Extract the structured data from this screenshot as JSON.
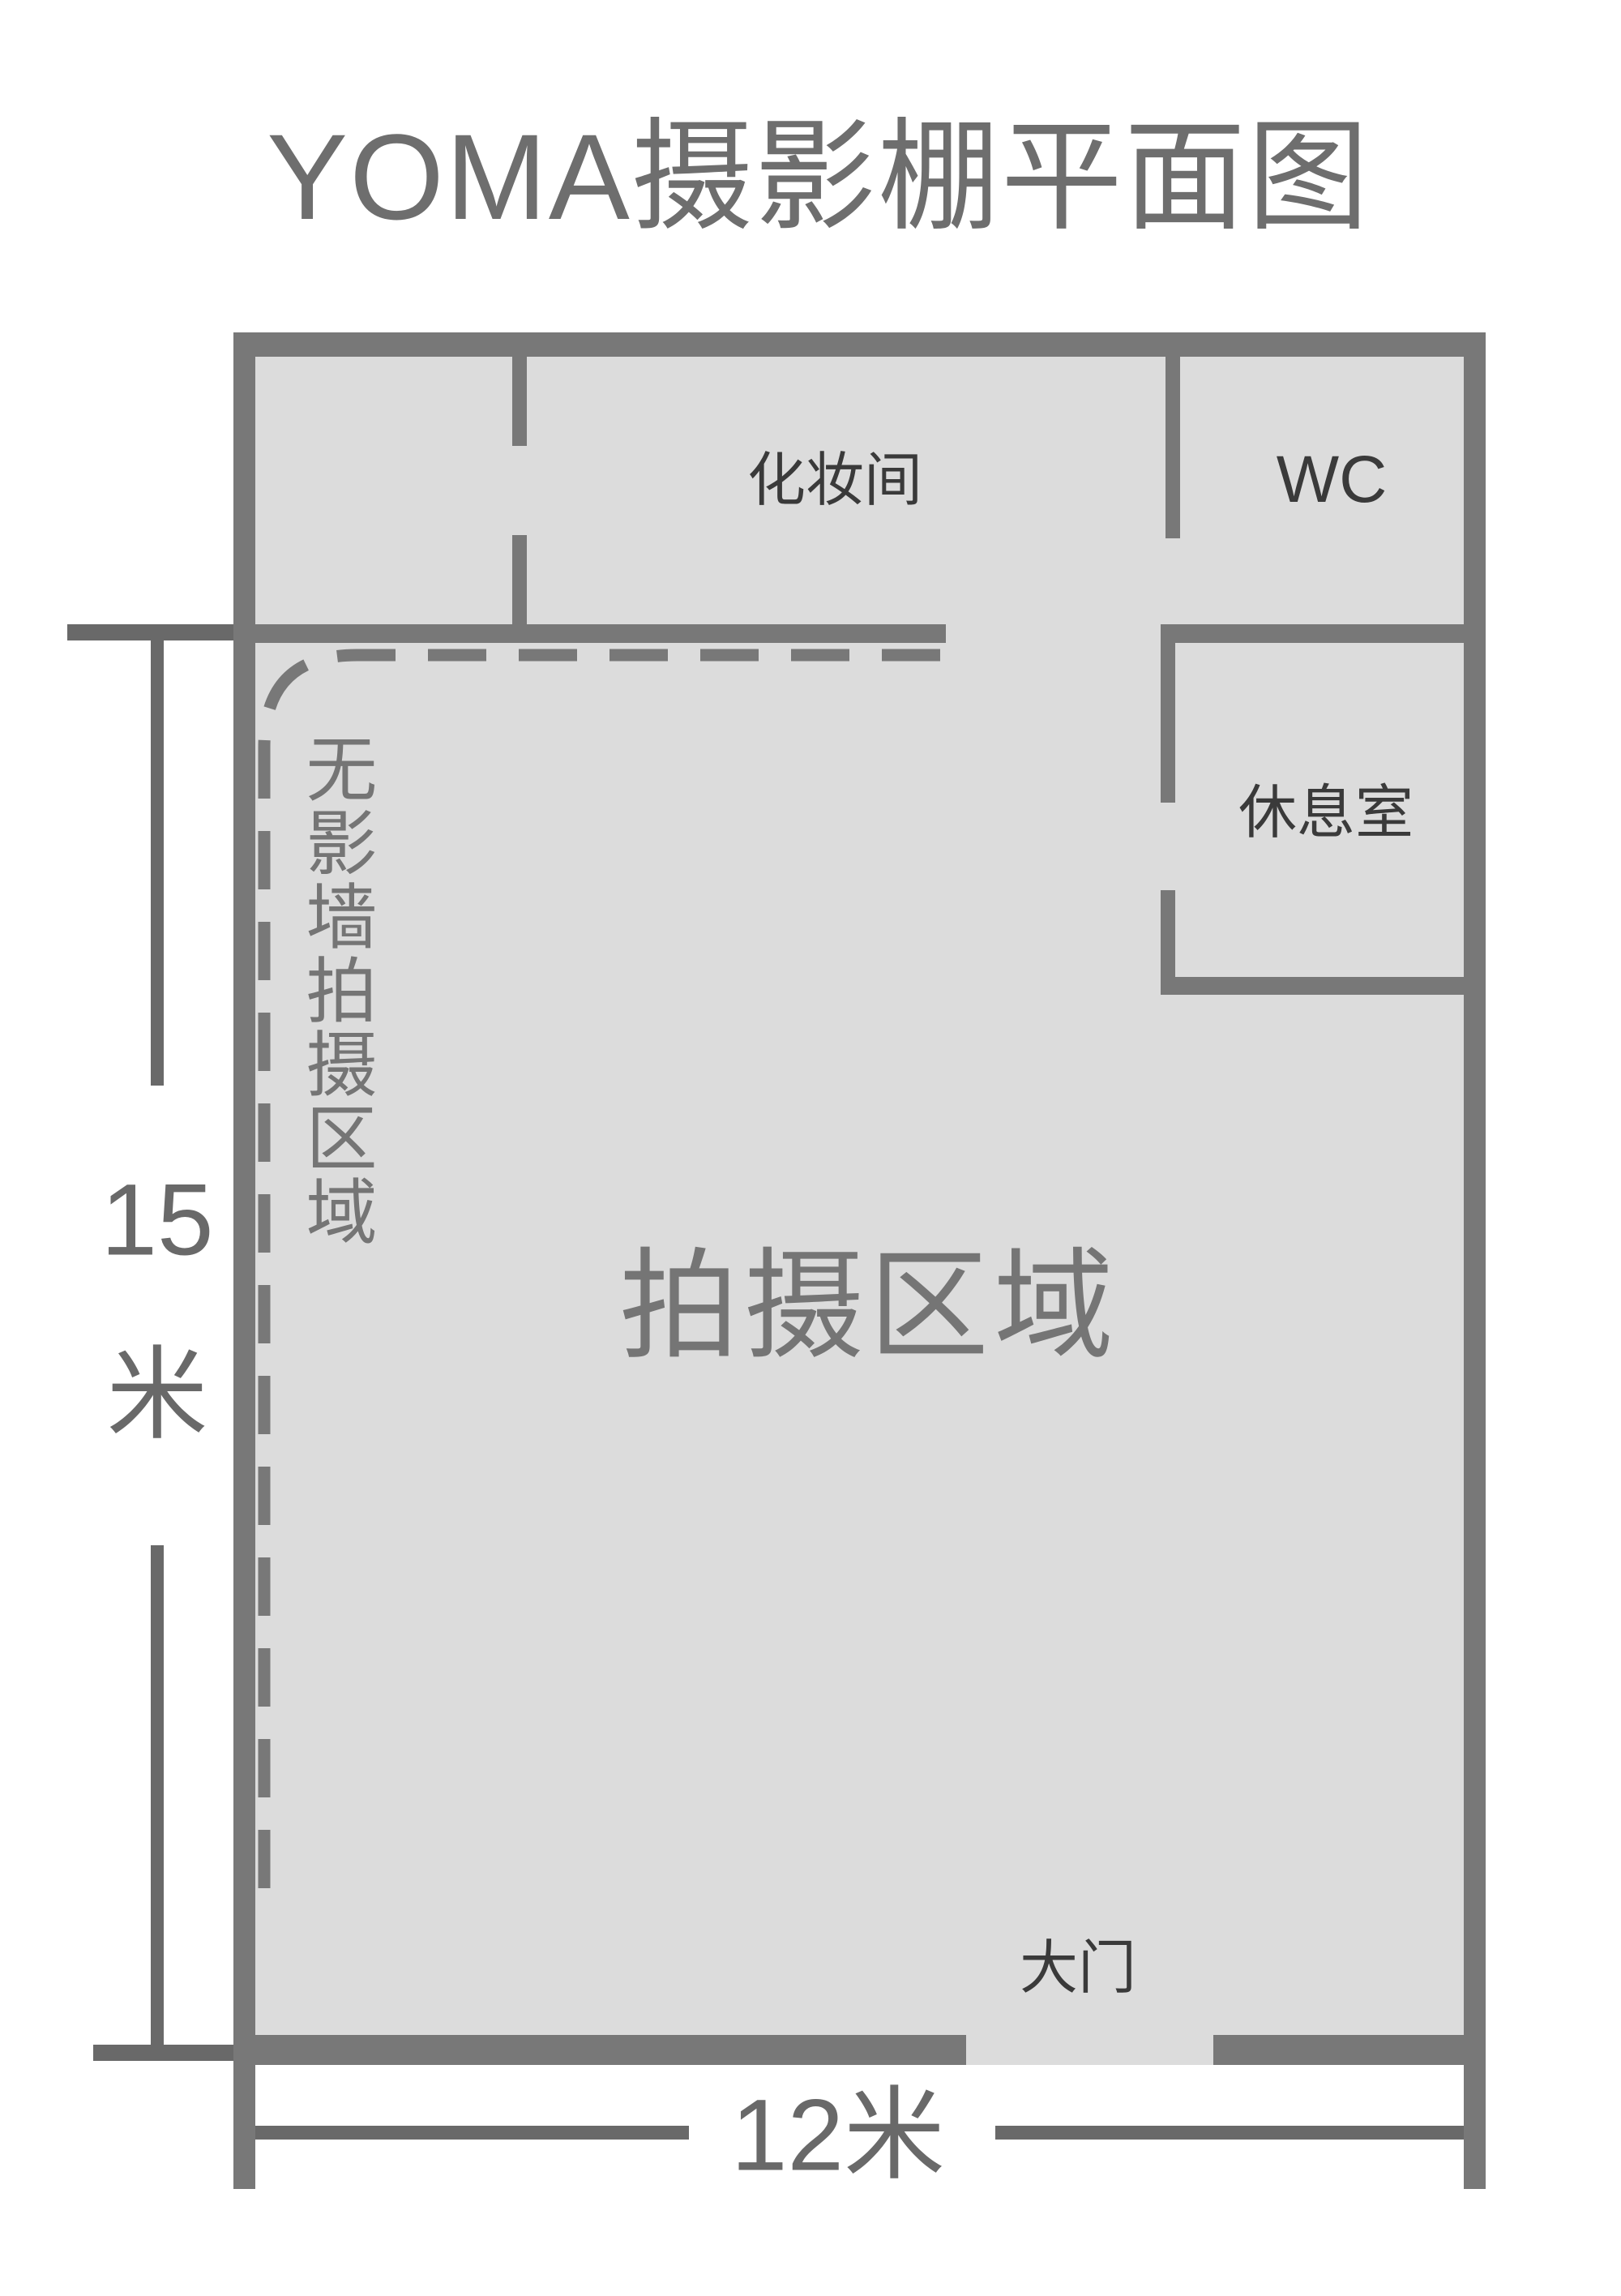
{
  "title": "YOMA摄影棚平面图",
  "rooms": {
    "makeup": "化妆间",
    "wc": "WC",
    "lounge": "休息室",
    "entrance": "大门"
  },
  "areas": {
    "shooting": "拍摄区域",
    "cyclorama": "无影墙拍摄区域"
  },
  "dimensions": {
    "height_value": "15",
    "height_unit": "米",
    "width_label": "12米"
  },
  "colors": {
    "wall": "#787878",
    "floor": "#dcdcdc",
    "room_label": "#3a3a3a",
    "area_label": "#757575",
    "dimension": "#696969",
    "title": "#6e6e6e",
    "background": "#ffffff"
  }
}
